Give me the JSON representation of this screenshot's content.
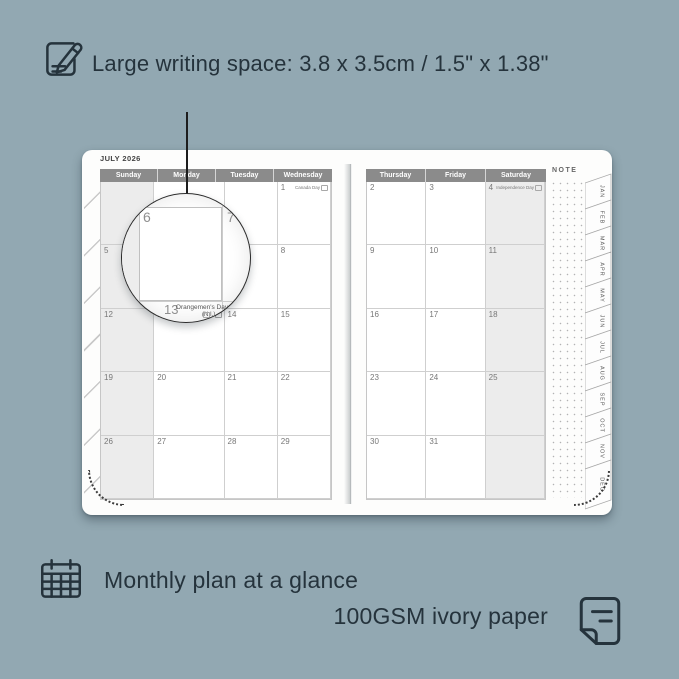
{
  "colors": {
    "background": "#92a8b2",
    "ink": "#25333c",
    "calendar_header": "#8b8b8b",
    "shaded_column": "#ececec",
    "page": "#fdfdfc"
  },
  "annotations": {
    "top": {
      "icon": "pencil-note-icon",
      "text": "Large writing space: 3.8 x 3.5cm / 1.5\" x 1.38\""
    },
    "bottom_left": {
      "icon": "calendar-grid-icon",
      "text": "Monthly plan at a glance"
    },
    "bottom_right": {
      "icon": "paper-icon",
      "text": "100GSM ivory paper"
    }
  },
  "planner": {
    "month_title": "JULY 2026",
    "note_label": "NOTE",
    "left_page": {
      "day_headers": [
        "Sunday",
        "Monday",
        "Tuesday",
        "Wednesday"
      ],
      "shaded_column_index": 0,
      "rows": [
        [
          {
            "day": ""
          },
          {
            "day": ""
          },
          {
            "day": ""
          },
          {
            "day": "1",
            "holiday": "Canada Day"
          }
        ],
        [
          {
            "day": "5"
          },
          {
            "day": "6"
          },
          {
            "day": "7"
          },
          {
            "day": "8"
          }
        ],
        [
          {
            "day": "12"
          },
          {
            "day": "13",
            "holiday": "Orangemen's Day (N.I.)"
          },
          {
            "day": "14"
          },
          {
            "day": "15"
          }
        ],
        [
          {
            "day": "19"
          },
          {
            "day": "20"
          },
          {
            "day": "21"
          },
          {
            "day": "22"
          }
        ],
        [
          {
            "day": "26"
          },
          {
            "day": "27"
          },
          {
            "day": "28"
          },
          {
            "day": "29"
          }
        ]
      ]
    },
    "right_page": {
      "day_headers": [
        "Thursday",
        "Friday",
        "Saturday"
      ],
      "shaded_column_index": 2,
      "rows": [
        [
          {
            "day": "2"
          },
          {
            "day": "3"
          },
          {
            "day": "4",
            "holiday": "Independence Day"
          }
        ],
        [
          {
            "day": "9"
          },
          {
            "day": "10"
          },
          {
            "day": "11"
          }
        ],
        [
          {
            "day": "16"
          },
          {
            "day": "17"
          },
          {
            "day": "18"
          }
        ],
        [
          {
            "day": "23"
          },
          {
            "day": "24"
          },
          {
            "day": "25"
          }
        ],
        [
          {
            "day": "30"
          },
          {
            "day": "31"
          },
          {
            "day": ""
          }
        ]
      ]
    },
    "month_tabs": [
      "JAN",
      "FEB",
      "MAR",
      "APR",
      "MAY",
      "JUN",
      "JUL",
      "AUG",
      "SEP",
      "OCT",
      "NOV",
      "DEC"
    ],
    "magnifier": {
      "top_left_day": "6",
      "top_right_day": "7",
      "bottom_day": "13",
      "holiday_line1": "Orangemen's Day",
      "holiday_line2": "(N.I.)",
      "adjacent_day": "14"
    }
  }
}
